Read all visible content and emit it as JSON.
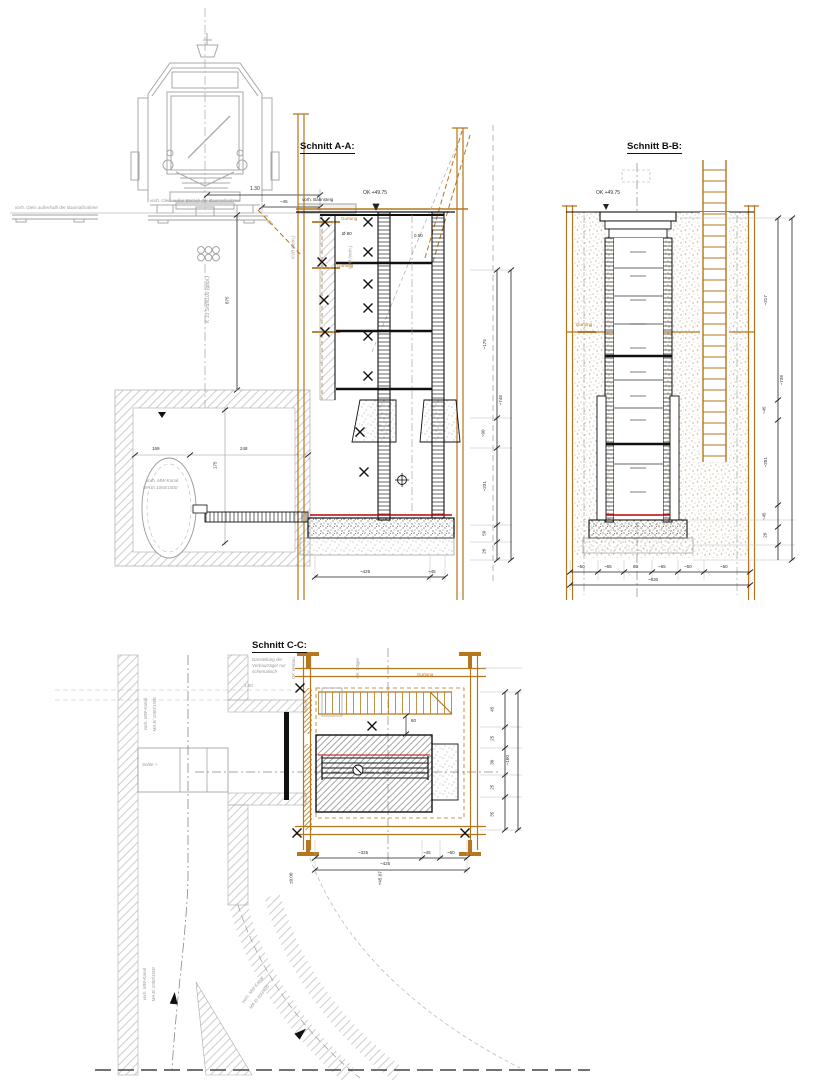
{
  "sections": {
    "a_title": "Schnitt A-A:",
    "b_title": "Schnitt B-B:",
    "c_title": "Schnitt C-C:"
  },
  "c_note": [
    "Darstellung der",
    "Verbauträger nur",
    "schematisch"
  ],
  "labels": {
    "track_left": "vorh. Gleis außerhalb der Baumaßnahme",
    "track_tram": "vorh. Gleis außer Betrieb der Baumaßnahme",
    "platform": "vorh. Bahnsteig",
    "ok_level": "OK +49.75",
    "axis_k": "K 10 SrdN100 (gepl.)",
    "kvb": "KVB (vorh.)",
    "gurtung": "Gurtung",
    "canal_mw_1": "vorh. MW-Kanal",
    "canal_mw_2": "MA Ei 1060/1500",
    "canal_600_2": "MA Ei 600/900",
    "dia80": "Ø 80",
    "d050": "0.50",
    "deg45": "45°",
    "dim130": "1.30",
    "dim45": "~45",
    "dim875": "875",
    "dim169": "169",
    "dim248": "248",
    "dim175": "175",
    "sohle": "Sohle +",
    "d150": "1.50",
    "dim80c": "80",
    "ok_verbau": "OK Verbau",
    "ok_traeger": "OK Träger",
    "pm000": "±0.00",
    "p4507": "+45.07"
  },
  "dims": {
    "a_right": [
      "~175",
      "~90",
      "~231",
      "50",
      "20"
    ],
    "a_right_total": "~748",
    "a_bottom": [
      "~425",
      "~45"
    ],
    "b_bottom": [
      "~50",
      "~65",
      "80",
      "~65",
      "~50",
      "~50"
    ],
    "b_bottom_total": "~530",
    "b_right": [
      "~317",
      "~45",
      "~201",
      "~45",
      "20"
    ],
    "b_right_total": "~738",
    "c_right": [
      "45",
      "25",
      "30",
      "25",
      "35"
    ],
    "c_right_total": "~160",
    "c_bottom": [
      "~325",
      "~45",
      "~60"
    ],
    "c_bottom_total": "~425"
  }
}
